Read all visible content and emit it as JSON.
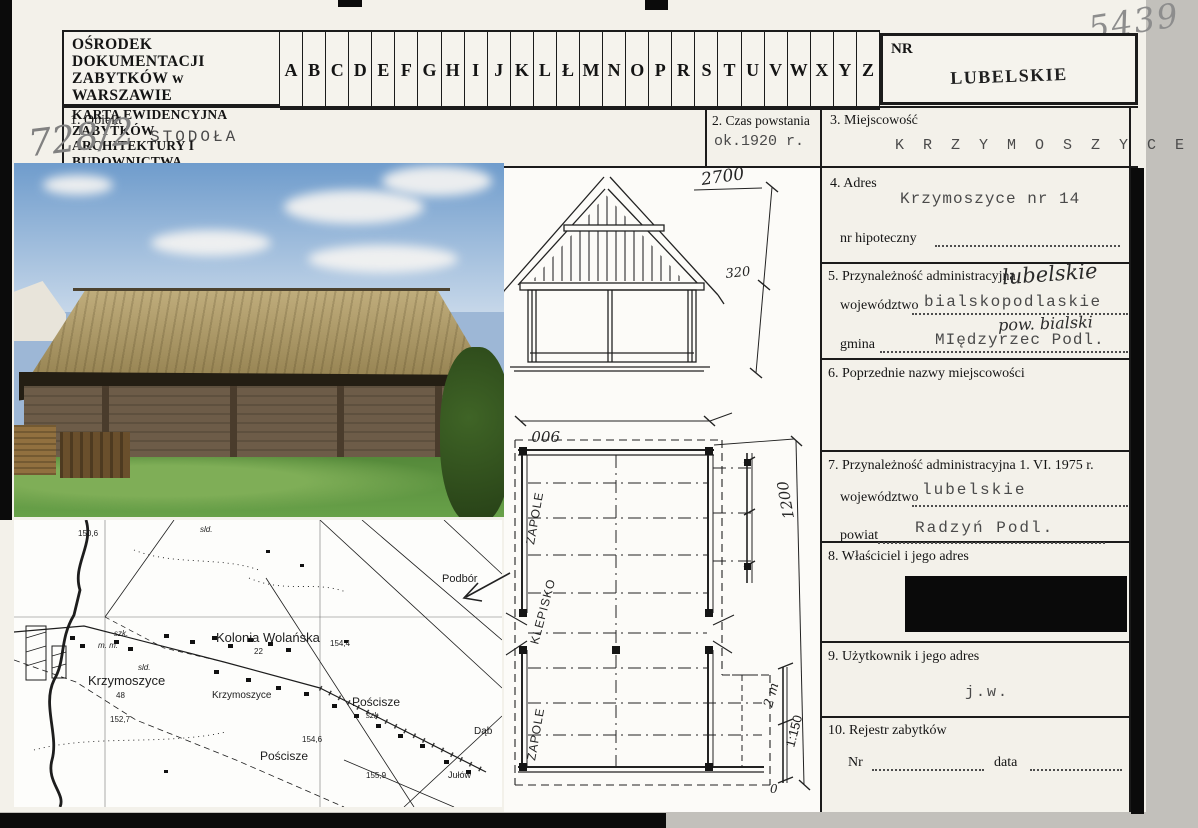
{
  "annotations": {
    "card_number": "5439",
    "object_number": "728/2"
  },
  "header": {
    "org_line1": "OŚRODEK DOKUMENTACJI",
    "org_line2": "ZABYTKÓW w WARSZAWIE",
    "card_line1": "KARTA EWIDENCYJNA ZABYTKÓW",
    "card_line2": "ARCHITEKTURY I BUDOWNICTWA",
    "letters": [
      "A",
      "B",
      "C",
      "D",
      "E",
      "F",
      "G",
      "H",
      "I",
      "J",
      "K",
      "L",
      "Ł",
      "M",
      "N",
      "O",
      "P",
      "R",
      "S",
      "T",
      "U",
      "V",
      "W",
      "X",
      "Y",
      "Z"
    ],
    "nr_label": "NR",
    "region": "LUBELSKIE"
  },
  "fields": {
    "f1": {
      "label": "1. Obiekt",
      "value": "STODOŁA"
    },
    "f2": {
      "label": "2. Czas powstania",
      "value": "ok.1920 r."
    },
    "f3": {
      "label": "3. Miejscowość",
      "value": "K R Z Y M O S Z Y C E"
    },
    "f4": {
      "label": "4. Adres",
      "value": "Krzymoszyce nr 14",
      "hipoteczny_label": "nr hipoteczny"
    },
    "f5": {
      "label": "5. Przynależność administracyjna",
      "wojewodztwo_label": "województwo",
      "wojewodztwo_value": "bialskopodlaskie",
      "hand_top": "lubelskie",
      "hand_mid": "pow. bialski",
      "gmina_label": "gmina",
      "gmina_value": "MIędzyrzec Podl."
    },
    "f6": {
      "label": "6. Poprzednie nazwy miejscowości"
    },
    "f7": {
      "label": "7. Przynależność administracyjna 1. VI. 1975 r.",
      "wojewodztwo_label": "województwo",
      "wojewodztwo_value": "lubelskie",
      "powiat_label": "powiat",
      "powiat_value": "Radzyń Podl."
    },
    "f8": {
      "label": "8. Właściciel i jego adres"
    },
    "f9": {
      "label": "9. Użytkownik i jego adres",
      "value": "j.w."
    },
    "f10": {
      "label": "10. Rejestr zabytków",
      "nr_label": "Nr",
      "data_label": "data"
    }
  },
  "drawings": {
    "section": {
      "dim_top": "2700",
      "dim_eave": "320"
    },
    "plan": {
      "dim_width": "900",
      "dim_length": "1200",
      "room_top": "ZAPOLE",
      "room_mid": "KLEPISKO",
      "room_bottom": "ZAPOLE",
      "scale_length": "2 m",
      "scale_ratio": "1:150",
      "scale_zero": "0"
    }
  },
  "map": {
    "labels": [
      {
        "t": "150,6",
        "x": 64,
        "y": 16,
        "s": 8
      },
      {
        "t": "sld.",
        "x": 186,
        "y": 12,
        "s": 8,
        "i": 1
      },
      {
        "t": "szk.",
        "x": 100,
        "y": 116,
        "s": 8,
        "i": 1
      },
      {
        "t": "m. m.",
        "x": 84,
        "y": 128,
        "s": 8,
        "i": 1
      },
      {
        "t": "Krzymoszyce",
        "x": 74,
        "y": 165,
        "s": 13
      },
      {
        "t": "48",
        "x": 102,
        "y": 178,
        "s": 8
      },
      {
        "t": "sld.",
        "x": 124,
        "y": 150,
        "s": 8,
        "i": 1
      },
      {
        "t": "Kolonia Wolańska",
        "x": 202,
        "y": 122,
        "s": 13
      },
      {
        "t": "22",
        "x": 240,
        "y": 134,
        "s": 8
      },
      {
        "t": "154,4",
        "x": 316,
        "y": 126,
        "s": 8
      },
      {
        "t": "Krzymoszyce",
        "x": 198,
        "y": 178,
        "s": 10
      },
      {
        "t": "Pościsze",
        "x": 338,
        "y": 186,
        "s": 12
      },
      {
        "t": "szk.",
        "x": 352,
        "y": 198,
        "s": 8,
        "i": 1
      },
      {
        "t": "Podbór",
        "x": 428,
        "y": 62,
        "s": 11
      },
      {
        "t": "152,7",
        "x": 96,
        "y": 202,
        "s": 8
      },
      {
        "t": "154,6",
        "x": 288,
        "y": 222,
        "s": 8
      },
      {
        "t": "Pościsze",
        "x": 246,
        "y": 240,
        "s": 12
      },
      {
        "t": "155,9",
        "x": 352,
        "y": 258,
        "s": 8
      },
      {
        "t": "Dąb",
        "x": 460,
        "y": 214,
        "s": 10
      },
      {
        "t": "Jułów",
        "x": 434,
        "y": 258,
        "s": 9
      }
    ]
  }
}
